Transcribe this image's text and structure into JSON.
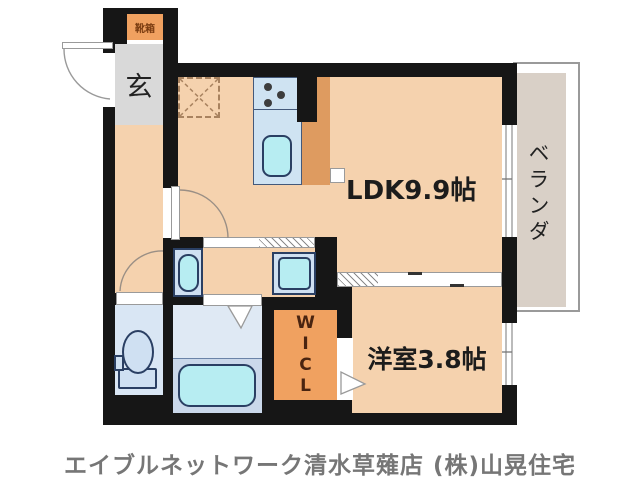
{
  "floorplan": {
    "shoe_box_label": "靴箱",
    "entrance_label": "玄",
    "ldk_label": "LDK9.9帖",
    "western_room_label": "洋室3.8帖",
    "veranda_label": "ベランダ",
    "wicl_letters": [
      "W",
      "I",
      "C",
      "L"
    ],
    "caption": "エイブルネットワーク清水草薙店 (株)山晃住宅",
    "colors": {
      "wall": "#161616",
      "room_floor": "#f5d2ae",
      "accent_orange": "#f0a160",
      "kitchen_counter": "#de9b60",
      "fixture_blue": "#cfe0f2",
      "fixture_cyan": "#b7edf2",
      "bathroom_floor": "#dfe9f4",
      "toilet_floor": "#d9e6f4",
      "veranda_gray": "#d9d0c7",
      "entrance_gray": "#d9d9d9",
      "caption_gray": "#767676"
    }
  }
}
